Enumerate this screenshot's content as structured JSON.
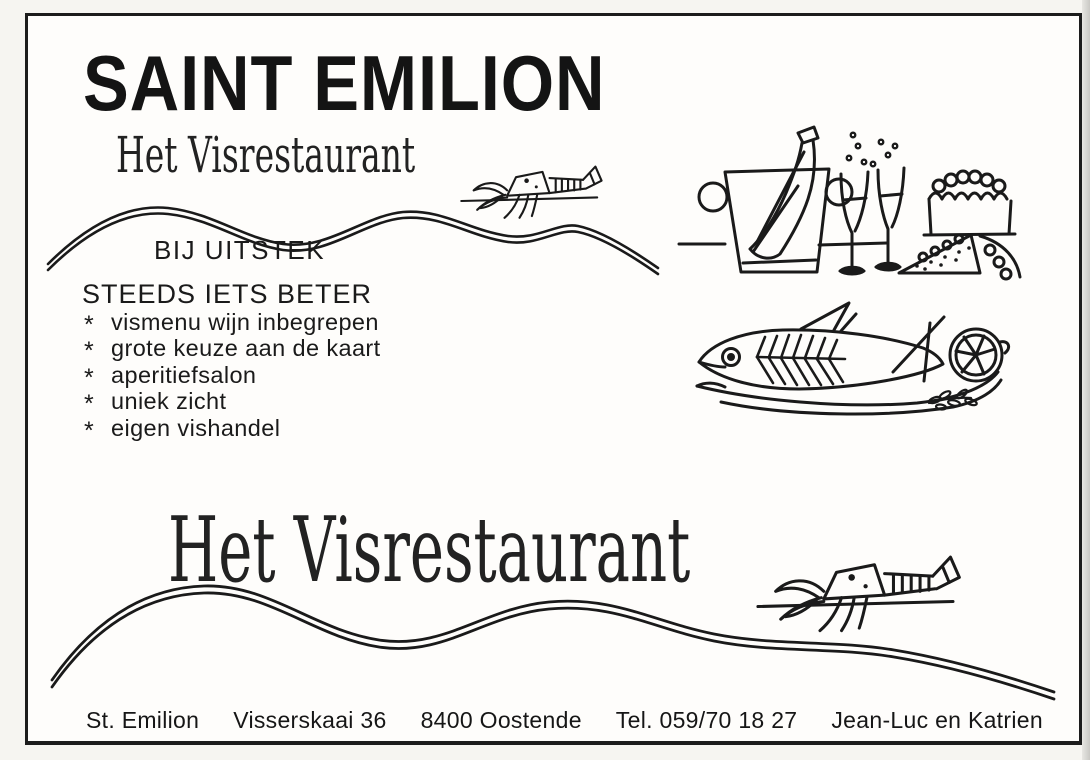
{
  "ad": {
    "title": "SAINT EMILION",
    "brand_script": "Het Visrestaurant",
    "tagline_top": "BIJ UITSTEK",
    "tagline_main": "STEEDS IETS BETER",
    "bullet_char": "*",
    "features": [
      "vismenu wijn inbegrepen",
      "grote keuze aan de kaart",
      "aperitiefsalon",
      "uniek zicht",
      "eigen vishandel"
    ],
    "footer": {
      "name": "St. Emilion",
      "street": "Visserskaai 36",
      "city": "8400 Oostende",
      "phone": "Tel. 059/70 18 27",
      "owners": "Jean-Luc en Katrien"
    },
    "illustrations": {
      "mascot": "lobster-icon",
      "divider": "wave-line",
      "top_right": "champagne-bucket-flutes-cake",
      "mid_right": "fish-on-platter-with-lemon"
    },
    "colors": {
      "ink": "#1a1a1a",
      "paper": "#fefdfb",
      "frame": "#1c1c1c"
    }
  }
}
